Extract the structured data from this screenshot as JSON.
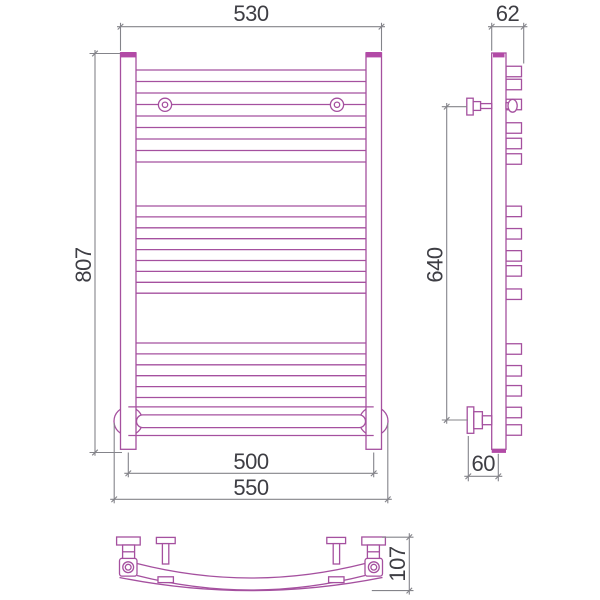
{
  "drawing": {
    "title": "Heated towel rail — technical dimension drawing (front, side and plan views)",
    "colors": {
      "product_line": "#a5509f",
      "product_fill": "#b24aa6",
      "dimension_line": "#84848a",
      "dimension_text": "#3e3e44",
      "background": "#ffffff"
    },
    "dimensions": {
      "front_top_width": "530",
      "front_height": "807",
      "front_bottom_rail_centers": "500",
      "front_bottom_overall": "550",
      "side_top_depth": "62",
      "side_bracket_span": "640",
      "side_bottom_depth": "60",
      "plan_depth": "107"
    },
    "front_bar_groups": [
      {
        "y_start": 70,
        "spacing": 11.5,
        "count": 9
      },
      {
        "y_start": 206,
        "spacing": 10.9,
        "count": 9
      },
      {
        "y_start": 343,
        "spacing": 10.9,
        "count": 6
      }
    ],
    "front_bars_x": {
      "x1": 136,
      "x2": 366
    },
    "side_stub_centers": [
      71.5,
      84.5,
      104.5,
      128,
      143.5,
      159,
      211.4,
      233.8,
      255.9,
      270.9,
      294.2,
      349,
      370.8,
      390.8,
      412.5,
      430
    ],
    "side_stub": {
      "x": 506,
      "width": 15.5,
      "height": 10.5
    }
  }
}
